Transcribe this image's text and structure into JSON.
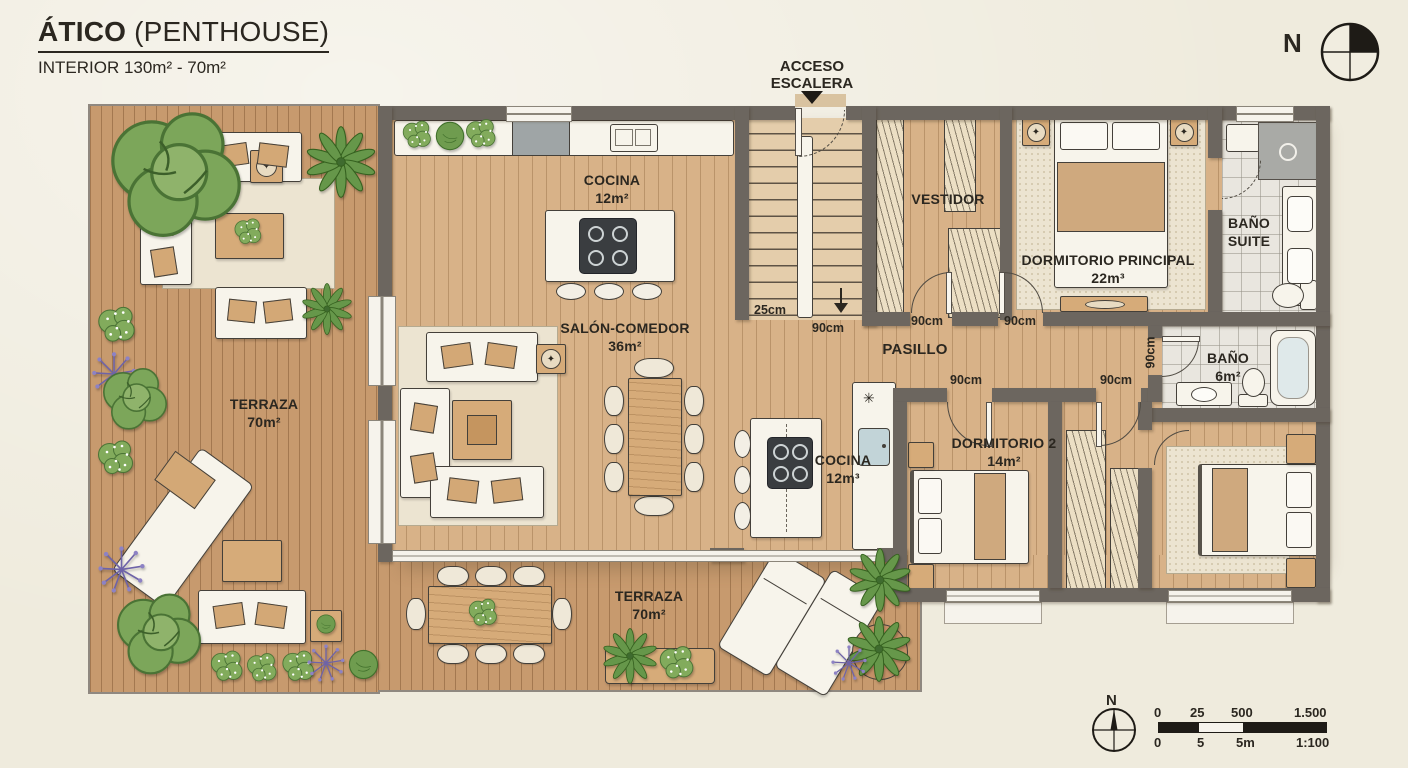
{
  "header": {
    "title_main": "ÁTICO",
    "title_paren": "(PENTHOUSE)",
    "subtitle": "INTERIOR 130m² - 70m²"
  },
  "access": {
    "line1": "ACCESO",
    "line2": "ESCALERA"
  },
  "compass_top": {
    "label": "N"
  },
  "rooms": {
    "terraza_left": {
      "name": "TERRAZA",
      "area": "70m²"
    },
    "terraza_bottom": {
      "name": "TERRAZA",
      "area": "70m²"
    },
    "cocina": {
      "name": "COCINA",
      "area": "12m²"
    },
    "salon": {
      "name": "SALÓN-COMEDOR",
      "area": "36m²"
    },
    "cocina2": {
      "name": "COCINA",
      "area": "12m³"
    },
    "vestidor": {
      "name": "VESTIDOR"
    },
    "principal": {
      "name": "DORMITORIO PRINCIPAL",
      "area": "22m³"
    },
    "bano_suite": {
      "line1": "BAÑO",
      "line2": "SUITE"
    },
    "pasillo": {
      "name": "PASILLO"
    },
    "bano": {
      "name": "BAÑO",
      "area": "6m²"
    },
    "dorm2": {
      "name": "DORMITORIO 2",
      "area": "14m²"
    }
  },
  "dims": {
    "stair_tread": "25cm",
    "stair_exit": "90cm",
    "door_vestidor": "90cm",
    "door_principal": "90cm",
    "door_dorm2": "90cm",
    "door_closet": "90cm",
    "door_bano": "90cm"
  },
  "icons": {
    "freezer": "✳",
    "decor_star": "✦"
  },
  "legend": {
    "compass_label": "N",
    "scale_top": [
      "0",
      "25",
      "500",
      "1.500"
    ],
    "scale_bottom": [
      "0",
      "5",
      "5m",
      "1:100"
    ]
  },
  "colors": {
    "paper": "#efebdd",
    "wall": "#6c665f",
    "deck": "#c79a6e",
    "wood": "#d8b288",
    "tile": "#e9e6df",
    "plant_green": "#6f9c4f",
    "accent_tan": "#d3a876"
  }
}
